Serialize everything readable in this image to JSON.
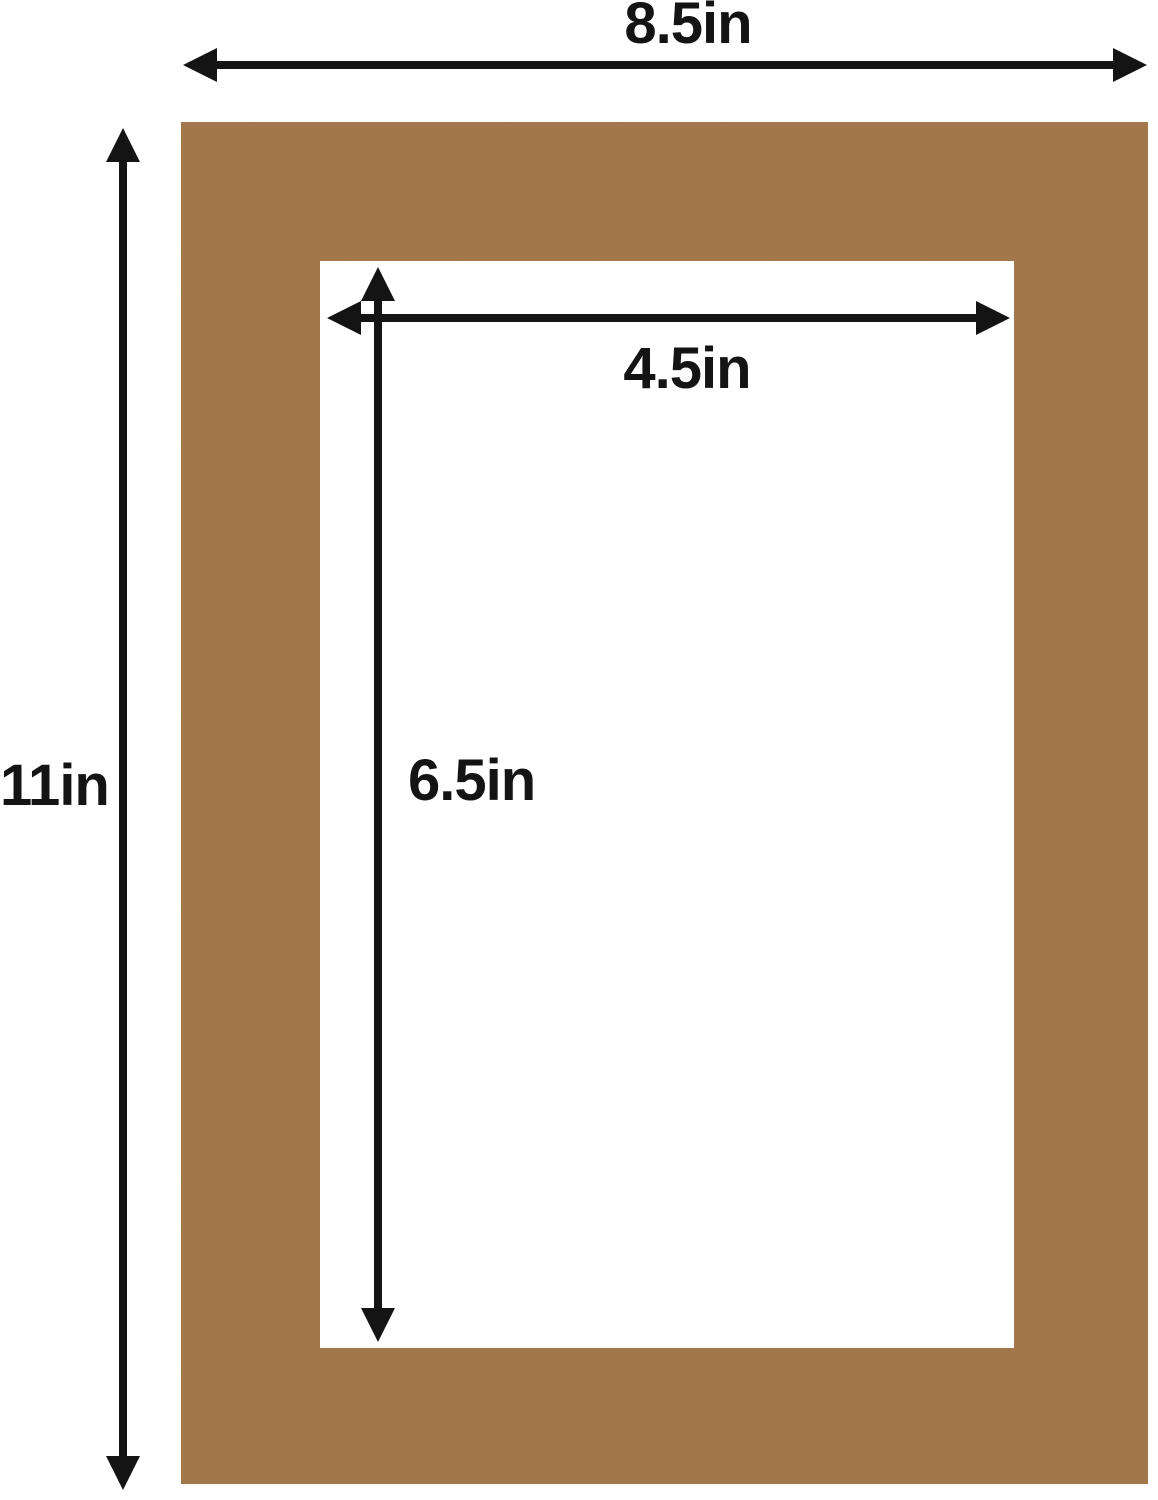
{
  "diagram": {
    "labels": {
      "outer_width": "8.5in",
      "outer_height": "11in",
      "opening_width": "4.5in",
      "opening_height": "6.5in"
    },
    "dimensions": {
      "unit": "in",
      "outer": {
        "width": 8.5,
        "height": 11
      },
      "opening": {
        "width": 4.5,
        "height": 6.5
      }
    },
    "colors": {
      "background": "#ffffff",
      "mat_board": "#bd8a58",
      "mat_opening": "#ffffff",
      "dimension_lines": "#141414"
    }
  }
}
